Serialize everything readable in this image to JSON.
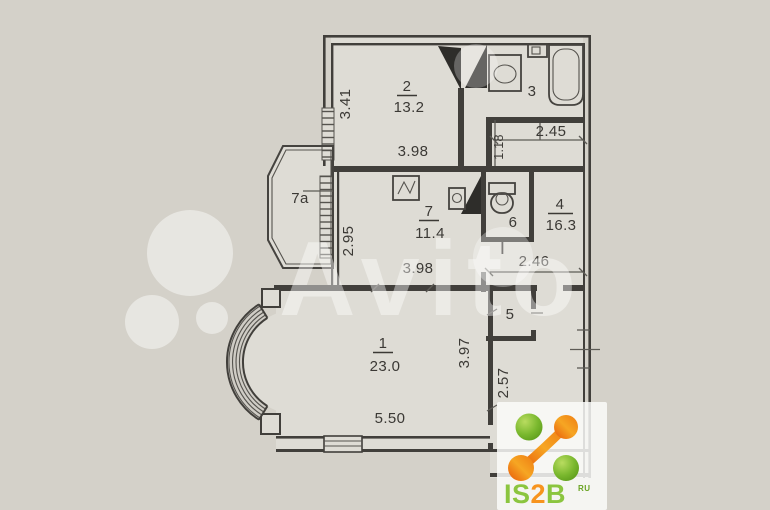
{
  "page": {
    "background": "#d4d1c9",
    "paper": "#dedcd5",
    "wall_color": "#413f3b",
    "text_color": "#3b3935"
  },
  "plan": {
    "rooms": [
      {
        "number": "1",
        "area": "23.0"
      },
      {
        "number": "2",
        "area": "13.2"
      },
      {
        "number": "3",
        "area": ""
      },
      {
        "number": "4",
        "area": "16.3"
      },
      {
        "number": "5",
        "area": ""
      },
      {
        "number": "6",
        "area": ""
      },
      {
        "number": "7",
        "area": "11.4"
      },
      {
        "number": "7a",
        "area": ""
      }
    ],
    "dimensions": {
      "room2_width": "3.98",
      "room2_height": "3.41",
      "hall_top_width": "2.45",
      "hall_top_height": "1.18",
      "kitchen_width": "3.98",
      "kitchen_height": "2.95",
      "hall_mid_width": "2.46",
      "room1_width": "5.50",
      "room1_height": "3.97",
      "hall_bottom_height": "2.57"
    }
  },
  "watermark": {
    "text": "Avito"
  },
  "logo": {
    "text_is": "IS",
    "text_2": "2",
    "text_b": "B",
    "text_suffix": "RU",
    "green": "#8bc53f",
    "orange": "#f7941e"
  }
}
